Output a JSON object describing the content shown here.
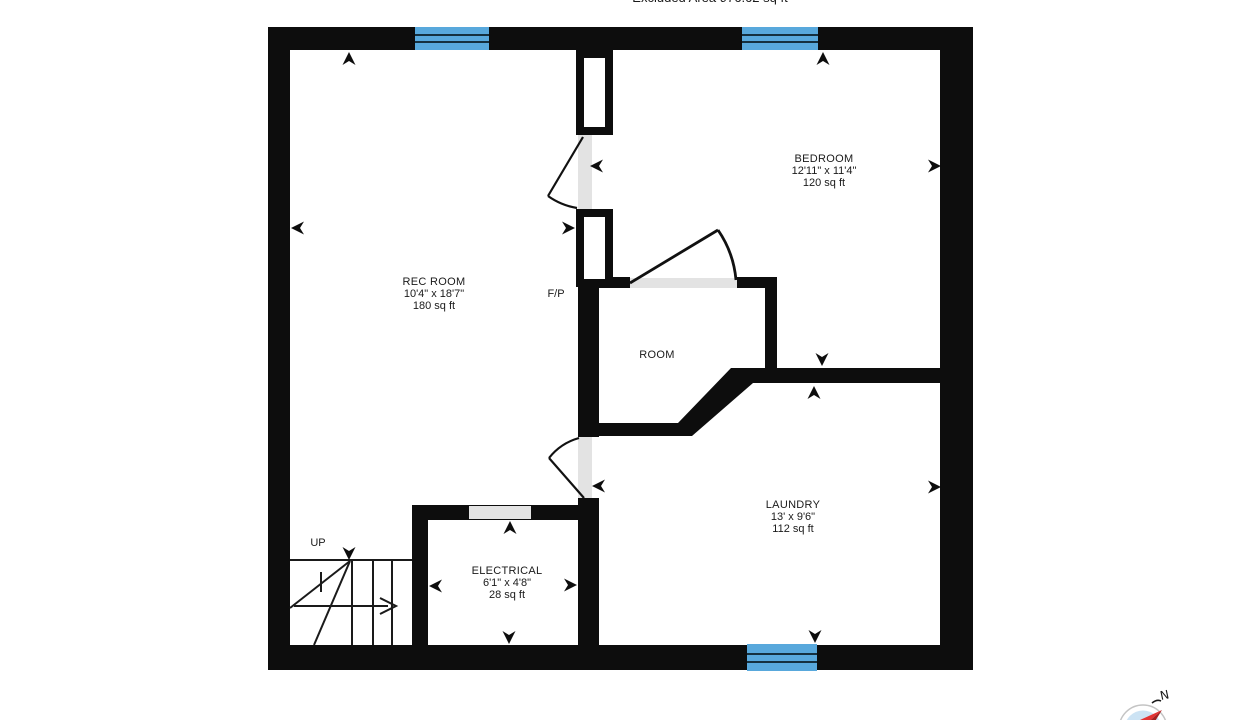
{
  "header": {
    "excluded_area_label": "Excluded Area 976.62 sq ft"
  },
  "colors": {
    "wall_black": "#0d0d0d",
    "window_blue": "#58a8dc",
    "opening_gray": "#e3e3e3",
    "compass_face_blue": "#cce3f4",
    "compass_needle_red": "#e23333",
    "compass_needle_dark_red": "#a32020"
  },
  "rooms": {
    "rec_room": {
      "name": "REC ROOM",
      "dimensions": "10'4\" x 18'7\"",
      "area": "180 sq ft"
    },
    "bedroom": {
      "name": "BEDROOM",
      "dimensions": "12'11\" x 11'4\"",
      "area": "120 sq ft"
    },
    "room": {
      "name": "ROOM"
    },
    "laundry": {
      "name": "LAUNDRY",
      "dimensions": "13' x 9'6\"",
      "area": "112 sq ft"
    },
    "electrical": {
      "name": "ELECTRICAL",
      "dimensions": "6'1\" x 4'8\"",
      "area": "28 sq ft"
    }
  },
  "labels": {
    "fireplace": "F/P",
    "stairs_up": "UP",
    "compass_north": "N"
  },
  "arrows": [
    {
      "x": 349,
      "y": 52,
      "dir": "up"
    },
    {
      "x": 291,
      "y": 228,
      "dir": "left"
    },
    {
      "x": 590,
      "y": 166,
      "dir": "left"
    },
    {
      "x": 575,
      "y": 228,
      "dir": "right"
    },
    {
      "x": 823,
      "y": 52,
      "dir": "up"
    },
    {
      "x": 941,
      "y": 166,
      "dir": "right"
    },
    {
      "x": 822,
      "y": 366,
      "dir": "down"
    },
    {
      "x": 814,
      "y": 386,
      "dir": "up"
    },
    {
      "x": 941,
      "y": 487,
      "dir": "right"
    },
    {
      "x": 815,
      "y": 643,
      "dir": "down"
    },
    {
      "x": 592,
      "y": 486,
      "dir": "left"
    },
    {
      "x": 349,
      "y": 560,
      "dir": "down"
    },
    {
      "x": 429,
      "y": 586,
      "dir": "left"
    },
    {
      "x": 577,
      "y": 585,
      "dir": "right"
    },
    {
      "x": 509,
      "y": 644,
      "dir": "down"
    },
    {
      "x": 510,
      "y": 521,
      "dir": "up"
    }
  ]
}
